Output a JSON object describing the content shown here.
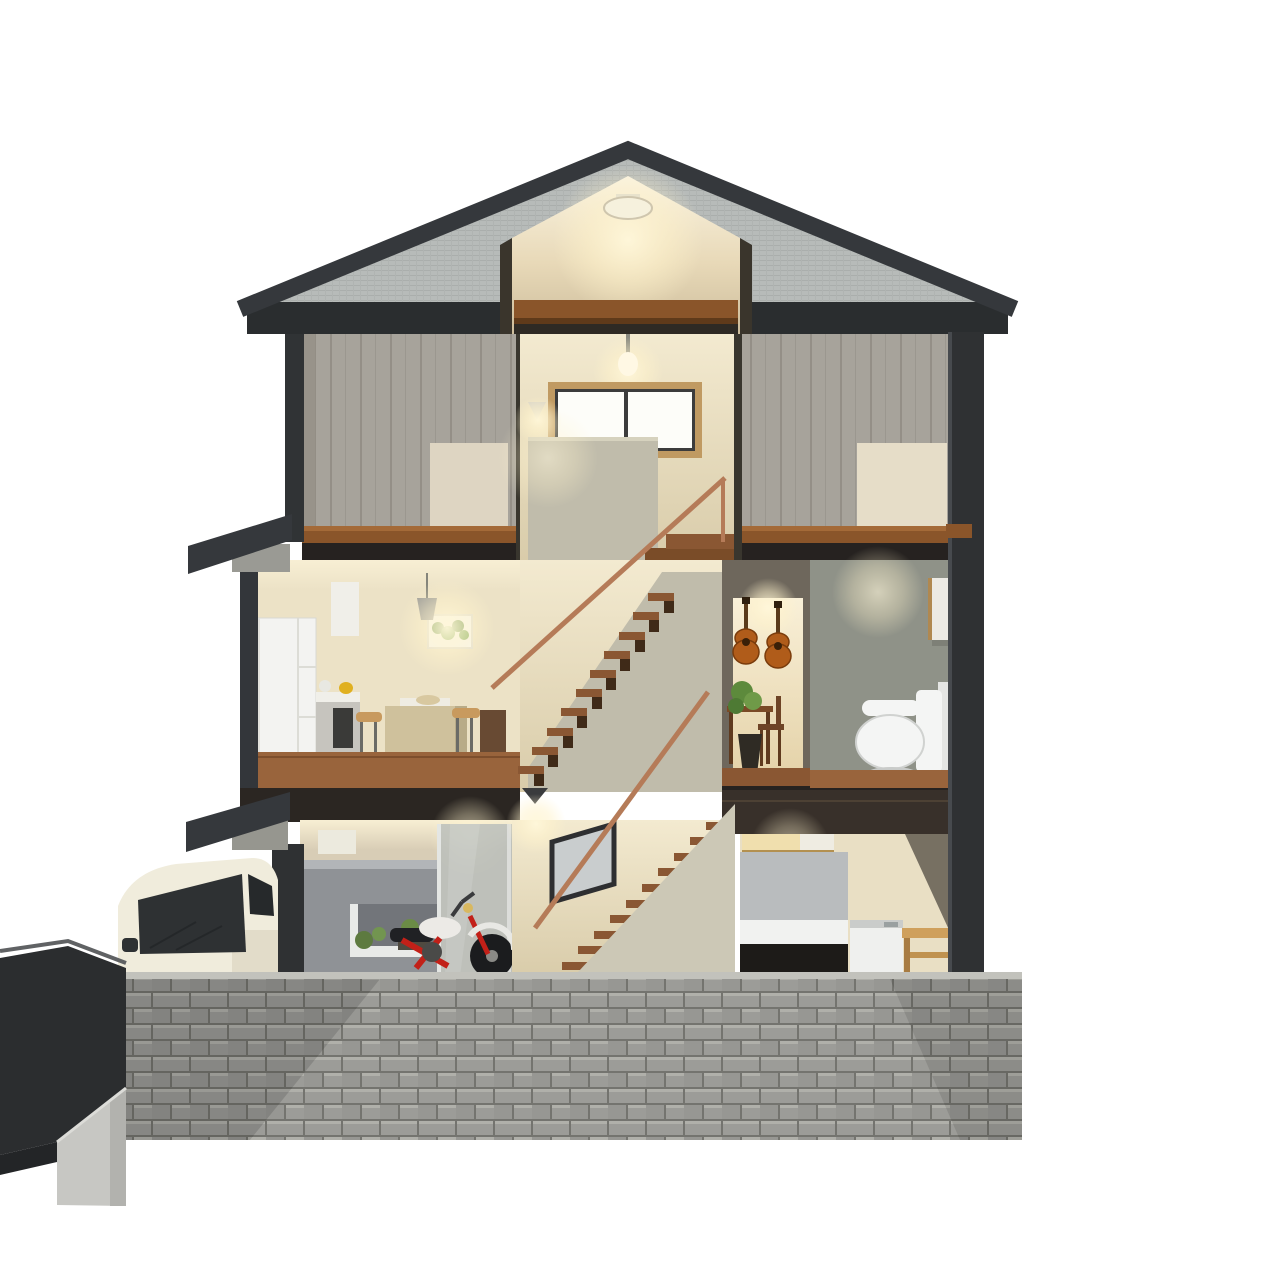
{
  "scene": {
    "description": "3D architectural cutaway cross-section rendering of a three-story house",
    "rooms": [
      "attic loft with ceiling light",
      "second-floor bedroom left",
      "second-floor stair hall with window and sconce",
      "second-floor bedroom right",
      "kitchen-dining with island and pendant light",
      "central stairwell with copper handrails",
      "music room with two guitars, desk, chair and plant",
      "toilet room",
      "garage with motorcycle and glass partition",
      "ground-floor stair hall with slanted window and wall lamp",
      "laundry room with washing machine and wooden bench"
    ],
    "exterior": [
      "dark gray gable roof",
      "gray concrete-block front fence wall",
      "white compact SUV",
      "dark driveway ramp with concrete curb"
    ]
  },
  "colors": {
    "bg": "#ffffff",
    "roof-fascia": "#35383c",
    "roof-surface": "#b6bab8",
    "attic-warm": "#d9c9a6",
    "beam-wood": "#8a552a",
    "plank-wall": "#a7a39b",
    "panel-light": "#ded5c2",
    "hall-wall": "#e9dfc4",
    "window-frame": "#c09a62",
    "window-pane": "#fdfdf9",
    "stair-wall": "#c0bcab",
    "stair-wall-light": "#ccc8b6",
    "rail-copper": "#b57b58",
    "tread-wood": "#8a5733",
    "floor-wood": "#99643c",
    "floor-edge": "#262220",
    "cut-wall": "#2f3133",
    "cream-lit": "#f7edd2",
    "fridge-white": "#f3f3f1",
    "island-wood": "#cfc19c",
    "stool-tan": "#c89a5e",
    "art-green": "#5d8a3c",
    "guitar-body": "#b05c1a",
    "toilet-wall": "#8f9288",
    "porcelain": "#f4f5f4",
    "garage-partition": "#8f9296",
    "glass-gray": "#b8bdbb",
    "moto-red": "#c22018",
    "moto-dark": "#1b1c1e",
    "panel-gray": "#b9bcbe",
    "washer-white": "#eff0ee",
    "bench-wood": "#cfa05c",
    "brick-block": "#9c9c98",
    "brick-mortar": "#74746f",
    "drive-dark": "#2b2d2f",
    "curb-concrete": "#c7c7c3",
    "car-cream": "#f0ecdc",
    "car-glass": "#2e3133",
    "glow-warm": "#fff7da"
  }
}
